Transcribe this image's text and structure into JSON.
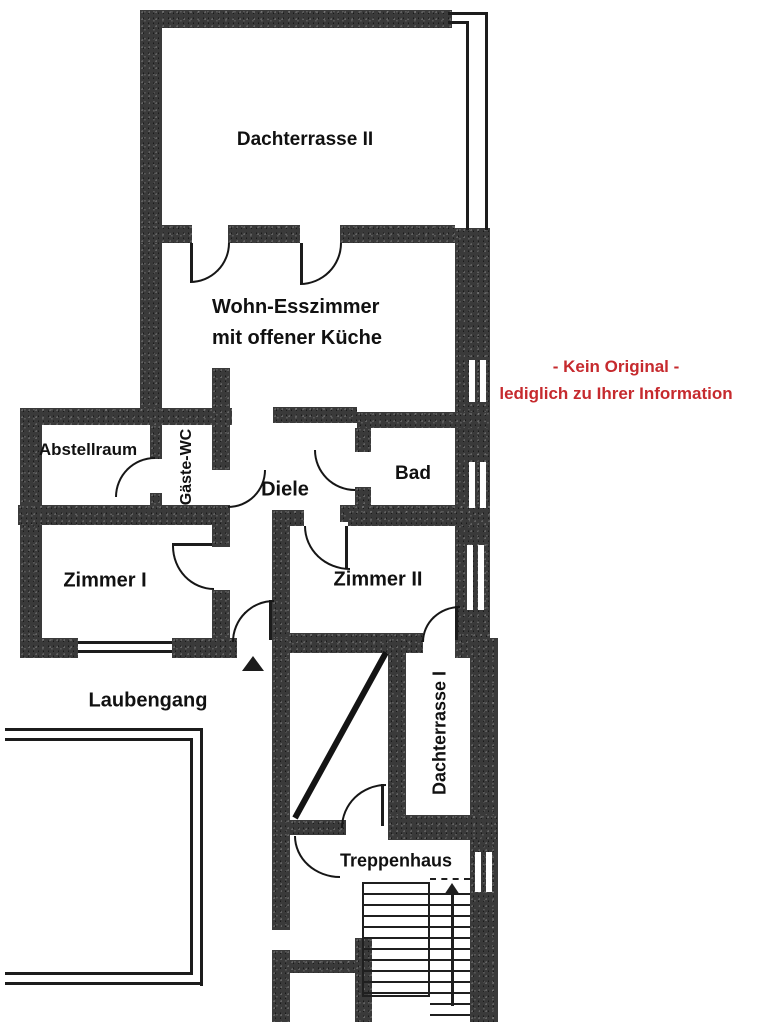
{
  "plan_type": "floor-plan",
  "rooms": {
    "dachterrasse2": "Dachterrasse II",
    "wohnzimmer_line1": "Wohn-Esszimmer",
    "wohnzimmer_line2": "mit offener Küche",
    "abstellraum": "Abstellraum",
    "gaeste_wc": "Gäste-WC",
    "diele": "Diele",
    "bad": "Bad",
    "zimmer1": "Zimmer I",
    "zimmer2": "Zimmer II",
    "laubengang": "Laubengang",
    "dachterrasse1": "Dachterrasse I",
    "treppenhaus": "Treppenhaus"
  },
  "disclaimer": {
    "line1": "- Kein Original -",
    "line2": "lediglich zu Ihrer Information",
    "color": "#c62a2e"
  },
  "colors": {
    "wall": "#3a3a3a",
    "line": "#1c1c1c",
    "background": "#ffffff"
  }
}
